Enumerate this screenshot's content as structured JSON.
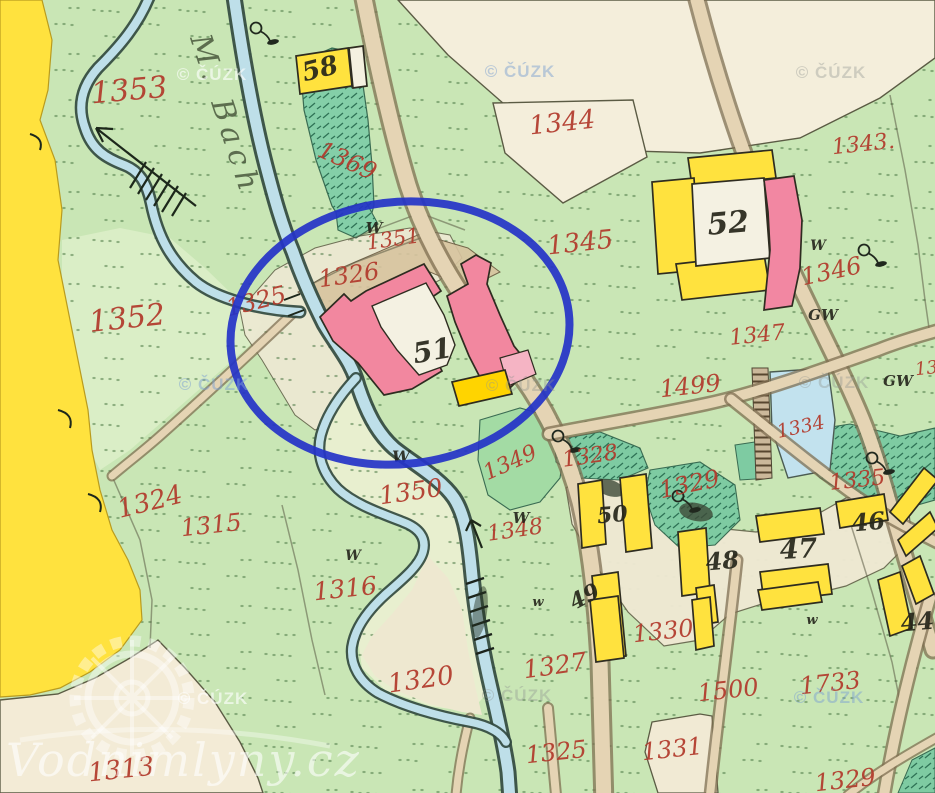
{
  "map": {
    "type": "historical-cadastral-map",
    "annotation_circle": {
      "color": "#2433c8"
    },
    "stream_label": {
      "t": "M. Bach",
      "x": 216,
      "y": 118,
      "r": 72,
      "s": 30
    },
    "brand_watermark": {
      "t": "Vodnimlyny.cz",
      "x": 6,
      "y": 776,
      "s": 46
    },
    "colors": {
      "field_green": "#c9e6b5",
      "pale_green": "#e3efcd",
      "cream": "#f3ecd7",
      "yellow": "#ffe23e",
      "building_pink": "#f2879f",
      "water": "#bedfe9",
      "road": "#e5d4b4",
      "garden_green": "#84cfa8",
      "number_red": "#b23a2c",
      "circle_blue": "#2433c8"
    },
    "parcel_numbers_red": [
      {
        "t": "1353",
        "x": 130,
        "y": 100,
        "r": -5,
        "s": 30
      },
      {
        "t": "1369",
        "x": 344,
        "y": 168,
        "r": 24,
        "s": 24
      },
      {
        "t": "1351",
        "x": 394,
        "y": 246,
        "r": -8,
        "s": 21
      },
      {
        "t": "1326",
        "x": 350,
        "y": 283,
        "r": -8,
        "s": 24
      },
      {
        "t": "1325",
        "x": 258,
        "y": 309,
        "r": -14,
        "s": 24
      },
      {
        "t": "1352",
        "x": 128,
        "y": 328,
        "r": -6,
        "s": 30
      },
      {
        "t": "1324",
        "x": 152,
        "y": 510,
        "r": -14,
        "s": 26
      },
      {
        "t": "1315",
        "x": 212,
        "y": 533,
        "r": -6,
        "s": 24
      },
      {
        "t": "1316",
        "x": 346,
        "y": 597,
        "r": -6,
        "s": 25
      },
      {
        "t": "1350",
        "x": 412,
        "y": 500,
        "r": -8,
        "s": 25
      },
      {
        "t": "1320",
        "x": 422,
        "y": 688,
        "r": -8,
        "s": 26
      },
      {
        "t": "1327",
        "x": 556,
        "y": 674,
        "r": -8,
        "s": 25
      },
      {
        "t": "1330",
        "x": 664,
        "y": 639,
        "r": -6,
        "s": 24
      },
      {
        "t": "1500",
        "x": 729,
        "y": 698,
        "r": -6,
        "s": 24
      },
      {
        "t": "1733",
        "x": 831,
        "y": 691,
        "r": -6,
        "s": 24
      },
      {
        "t": "1331",
        "x": 673,
        "y": 757,
        "r": -6,
        "s": 24
      },
      {
        "t": "1325",
        "x": 557,
        "y": 760,
        "r": -6,
        "s": 24
      },
      {
        "t": "1313",
        "x": 122,
        "y": 778,
        "r": -6,
        "s": 26
      },
      {
        "t": "1329",
        "x": 846,
        "y": 788,
        "r": -6,
        "s": 24
      },
      {
        "t": "1344",
        "x": 563,
        "y": 131,
        "r": -6,
        "s": 26
      },
      {
        "t": "1345",
        "x": 581,
        "y": 251,
        "r": -6,
        "s": 26
      },
      {
        "t": "1343.",
        "x": 864,
        "y": 151,
        "r": -6,
        "s": 22
      },
      {
        "t": "1346",
        "x": 833,
        "y": 279,
        "r": -12,
        "s": 24
      },
      {
        "t": "1347",
        "x": 758,
        "y": 342,
        "r": -6,
        "s": 22
      },
      {
        "t": "1499",
        "x": 691,
        "y": 394,
        "r": -6,
        "s": 24
      },
      {
        "t": "1334",
        "x": 802,
        "y": 433,
        "r": -12,
        "s": 19
      },
      {
        "t": "1335",
        "x": 858,
        "y": 487,
        "r": -6,
        "s": 22
      },
      {
        "t": "1348",
        "x": 516,
        "y": 537,
        "r": -8,
        "s": 22
      },
      {
        "t": "1349",
        "x": 513,
        "y": 469,
        "r": -24,
        "s": 22
      },
      {
        "t": "1328",
        "x": 591,
        "y": 463,
        "r": -8,
        "s": 22
      },
      {
        "t": "1329",
        "x": 691,
        "y": 492,
        "r": -12,
        "s": 24
      },
      {
        "t": "13",
        "x": 927,
        "y": 374,
        "r": -6,
        "s": 18
      }
    ],
    "building_numbers_black": [
      {
        "t": "58",
        "x": 322,
        "y": 77,
        "r": -14,
        "s": 26
      },
      {
        "t": "52",
        "x": 729,
        "y": 233,
        "r": -5,
        "s": 30
      },
      {
        "t": "51",
        "x": 434,
        "y": 360,
        "r": -10,
        "s": 28
      },
      {
        "t": "50",
        "x": 613,
        "y": 522,
        "r": -5,
        "s": 22
      },
      {
        "t": "49",
        "x": 588,
        "y": 603,
        "r": -28,
        "s": 22
      },
      {
        "t": "48",
        "x": 723,
        "y": 569,
        "r": -5,
        "s": 24
      },
      {
        "t": "47",
        "x": 799,
        "y": 558,
        "r": -3,
        "s": 27
      },
      {
        "t": "46",
        "x": 869,
        "y": 530,
        "r": -5,
        "s": 24
      },
      {
        "t": "44",
        "x": 918,
        "y": 630,
        "r": -5,
        "s": 24
      }
    ],
    "meadow_symbols": [
      {
        "t": "W",
        "x": 374,
        "y": 233,
        "s": 15
      },
      {
        "t": "W",
        "x": 401,
        "y": 462,
        "s": 16
      },
      {
        "t": "W",
        "x": 353,
        "y": 560,
        "s": 14
      },
      {
        "t": "W",
        "x": 521,
        "y": 523,
        "s": 15
      },
      {
        "t": "w",
        "x": 538,
        "y": 606,
        "s": 13
      },
      {
        "t": "w",
        "x": 812,
        "y": 624,
        "s": 13
      },
      {
        "t": "W",
        "x": 818,
        "y": 250,
        "s": 14
      },
      {
        "t": "GW",
        "x": 823,
        "y": 320,
        "s": 15
      },
      {
        "t": "GW",
        "x": 898,
        "y": 386,
        "s": 15
      }
    ],
    "tree_symbols": [
      {
        "x": 256,
        "y": 28
      },
      {
        "x": 864,
        "y": 250
      },
      {
        "x": 558,
        "y": 436
      },
      {
        "x": 678,
        "y": 496
      },
      {
        "x": 872,
        "y": 458
      }
    ],
    "watermarks_cuzk": [
      {
        "t": "© ČÚZK",
        "x": 212,
        "y": 80,
        "c": "light"
      },
      {
        "t": "© ČÚZK",
        "x": 520,
        "y": 77,
        "c": "blue"
      },
      {
        "t": "© ČÚZK",
        "x": 831,
        "y": 78,
        "c": "grey"
      },
      {
        "t": "© ČÚZK",
        "x": 214,
        "y": 390,
        "c": "blue"
      },
      {
        "t": "© ČÚZK",
        "x": 521,
        "y": 391,
        "c": "grey"
      },
      {
        "t": "© ČÚZK",
        "x": 834,
        "y": 388,
        "c": "grey"
      },
      {
        "t": "© ČÚZK",
        "x": 213,
        "y": 704,
        "c": "light"
      },
      {
        "t": "© ČÚZK",
        "x": 517,
        "y": 701,
        "c": "grey"
      },
      {
        "t": "© ČÚZK",
        "x": 829,
        "y": 703,
        "c": "blue"
      }
    ]
  }
}
